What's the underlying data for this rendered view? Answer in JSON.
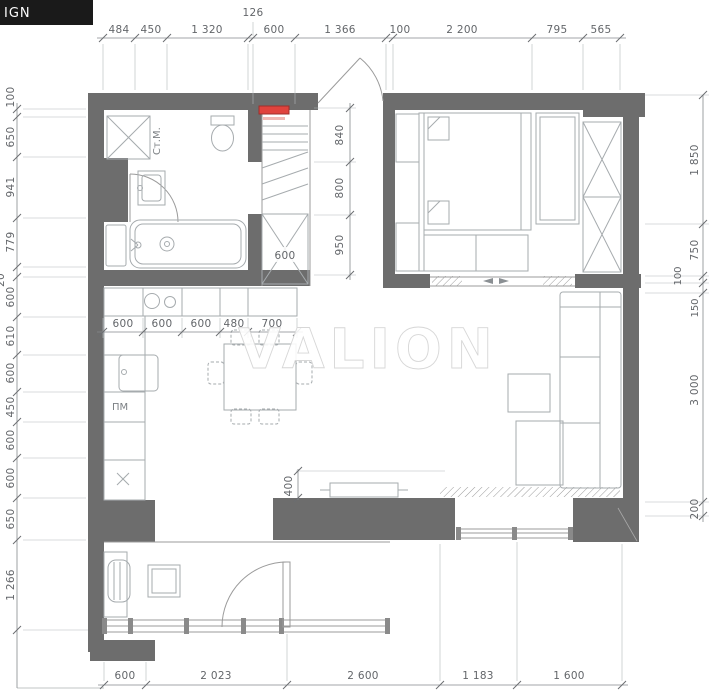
{
  "logo": {
    "text": "IGN"
  },
  "watermark": {
    "text": "VALION"
  },
  "room_labels": {
    "washing_machine": "Ст.М.",
    "dishwasher": "ПМ",
    "hob_mark": "Х"
  },
  "dimensions": {
    "top_secondary": "126",
    "top": [
      "484",
      "450",
      "1 320",
      "600",
      "1 366",
      "100",
      "2 200",
      "795",
      "565"
    ],
    "left": [
      "100",
      "650",
      "941",
      "779",
      "600",
      "610",
      "600",
      "450",
      "600",
      "600",
      "650",
      "1 266"
    ],
    "left_clipped": "20",
    "right": [
      "1 850",
      "750",
      "100",
      "150",
      "3 000",
      "200"
    ],
    "bottom": [
      "600",
      "2 023",
      "2 600",
      "1 183",
      "1 600"
    ],
    "hallway": [
      "840",
      "800",
      "950"
    ],
    "kitchen": [
      "600",
      "600",
      "600",
      "480",
      "700"
    ],
    "closet_width": "600",
    "tv_wall": "400"
  },
  "colors": {
    "wall": "#6d6d6d",
    "accent_red": "#e0433d"
  }
}
